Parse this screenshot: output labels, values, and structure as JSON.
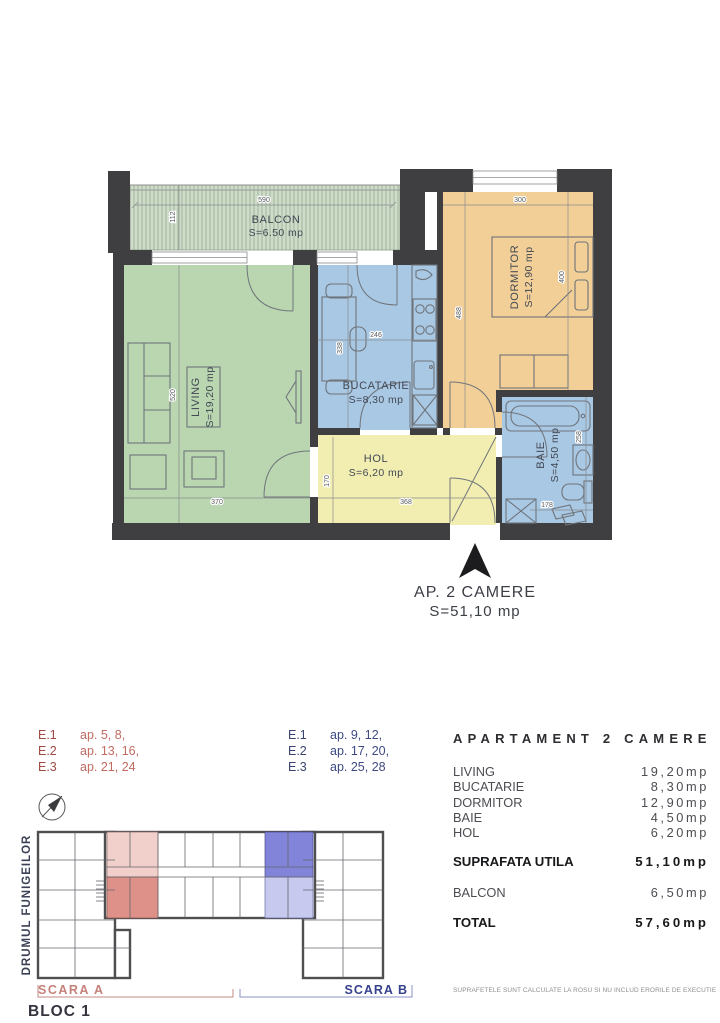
{
  "floorplan": {
    "rooms": {
      "balcon": {
        "name": "BALCON",
        "area": "S=6.50 mp"
      },
      "living": {
        "name": "LIVING",
        "area": "S=19,20 mp"
      },
      "bucatarie": {
        "name": "BUCATARIE",
        "area": "S=8,30 mp"
      },
      "dormitor": {
        "name": "DORMITOR",
        "area": "S=12,90 mp"
      },
      "hol": {
        "name": "HOL",
        "area": "S=6,20 mp"
      },
      "baie": {
        "name": "BAIE",
        "area": "S=4,50 mp"
      }
    },
    "dims": {
      "balcon_w": "590",
      "balcon_h": "112",
      "living_h": "520",
      "living_w": "370",
      "bucatarie_w": "246",
      "bucatarie_h": "338",
      "dormitor_w": "300",
      "dormitor_h": "488",
      "dormitor_bed": "400",
      "hol_w": "368",
      "hol_h": "170",
      "baie_h": "258",
      "baie_w": "178"
    },
    "entrance": {
      "title": "AP. 2 CAMERE",
      "area": "S=51,10 mp"
    }
  },
  "legend": {
    "scara_a": {
      "rows": [
        [
          "E.1",
          "ap. 5, 8,"
        ],
        [
          "E.2",
          "ap. 13, 16,"
        ],
        [
          "E.3",
          "ap. 21, 24"
        ]
      ]
    },
    "scara_b": {
      "rows": [
        [
          "E.1",
          "ap. 9, 12,"
        ],
        [
          "E.2",
          "ap. 17, 20,"
        ],
        [
          "E.3",
          "ap. 25, 28"
        ]
      ]
    }
  },
  "siteplan": {
    "street": "DRUMUL FUNIGEILOR",
    "scara_a_label": "SCARA A",
    "scara_b_label": "SCARA B",
    "bloc_label": "BLOC 1"
  },
  "summary": {
    "title": "APARTAMENT 2 CAMERE",
    "rows": [
      {
        "label": "LIVING",
        "value": "19,20mp"
      },
      {
        "label": "BUCATARIE",
        "value": "8,30mp"
      },
      {
        "label": "DORMITOR",
        "value": "12,90mp"
      },
      {
        "label": "BAIE",
        "value": "4,50mp"
      },
      {
        "label": "HOL",
        "value": "6,20mp"
      }
    ],
    "subtotal": {
      "label": "SUPRAFATA UTILA",
      "value": "51,10mp"
    },
    "balcon": {
      "label": "BALCON",
      "value": "6,50mp"
    },
    "total": {
      "label": "TOTAL",
      "value": "57,60mp"
    },
    "footnote": "SUPRAFETELE SUNT CALCULATE LA ROSU SI  NU INCLUD ERORILE DE EXECUTIE"
  },
  "colors": {
    "wall": "#3f3f41",
    "living": "#b9d6b0",
    "kitchen_bath": "#a9c8e4",
    "dormitor": "#f1cf97",
    "hol": "#f2eeb2",
    "balcon_bg": "#cfdcca",
    "balcon_hatch": "#9fb69b",
    "scara_a_red": "#bc6a62",
    "scara_b_blue": "#37428c",
    "unit_pink": "#f1cfca",
    "unit_red": "#dd9189",
    "unit_blue": "#8184d8",
    "unit_lavender": "#c7c9ef"
  }
}
